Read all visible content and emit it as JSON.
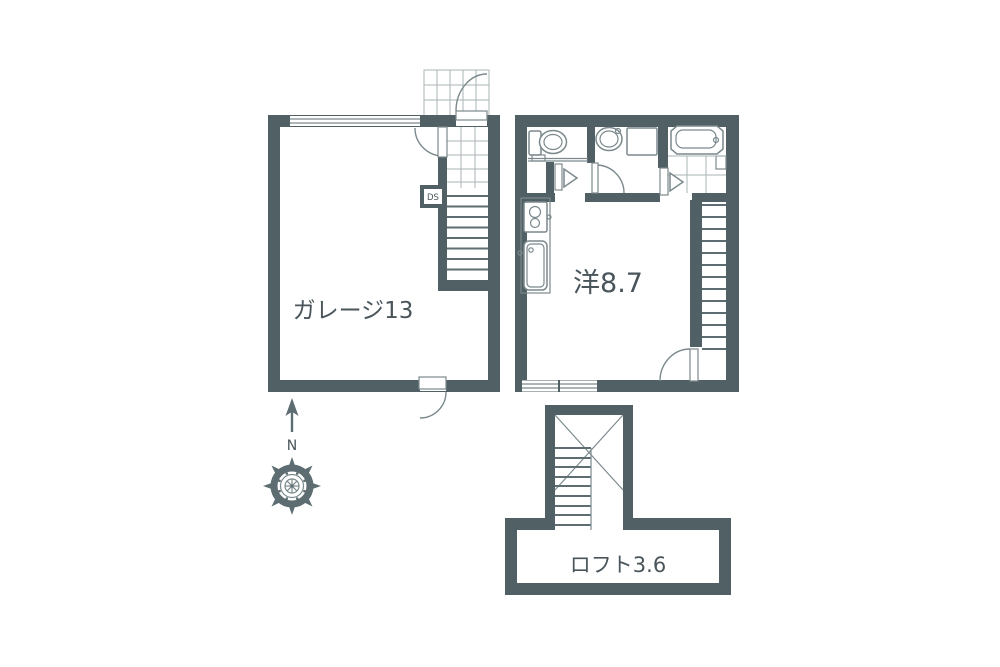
{
  "page": {
    "background": "#ffffff"
  },
  "colors": {
    "wall": "#506064",
    "line": "#7b898d",
    "grid": "#aab4b6",
    "tread": "#5d6d71",
    "text": "#49555a"
  },
  "rooms": [
    {
      "id": "garage",
      "label": "ガレージ13",
      "area_tatami": 13
    },
    {
      "id": "western-room",
      "label": "洋8.7",
      "area_tatami": 8.7
    },
    {
      "id": "loft",
      "label": "ロフト3.6",
      "area_tatami": 3.6
    }
  ],
  "annotations": {
    "duct_space": "DS",
    "compass_north": "N"
  },
  "icons": [
    "entrance-porch-tiles",
    "toilet-icon",
    "washbasin-icon",
    "washing-machine-pan-icon",
    "bathtub-icon",
    "stove-icon",
    "kitchen-sink-icon",
    "stairs-icon",
    "loft-stairs-icon",
    "compass-rose-icon",
    "north-arrow-icon",
    "door-swing-icon",
    "folding-door-icon",
    "window-icon"
  ]
}
